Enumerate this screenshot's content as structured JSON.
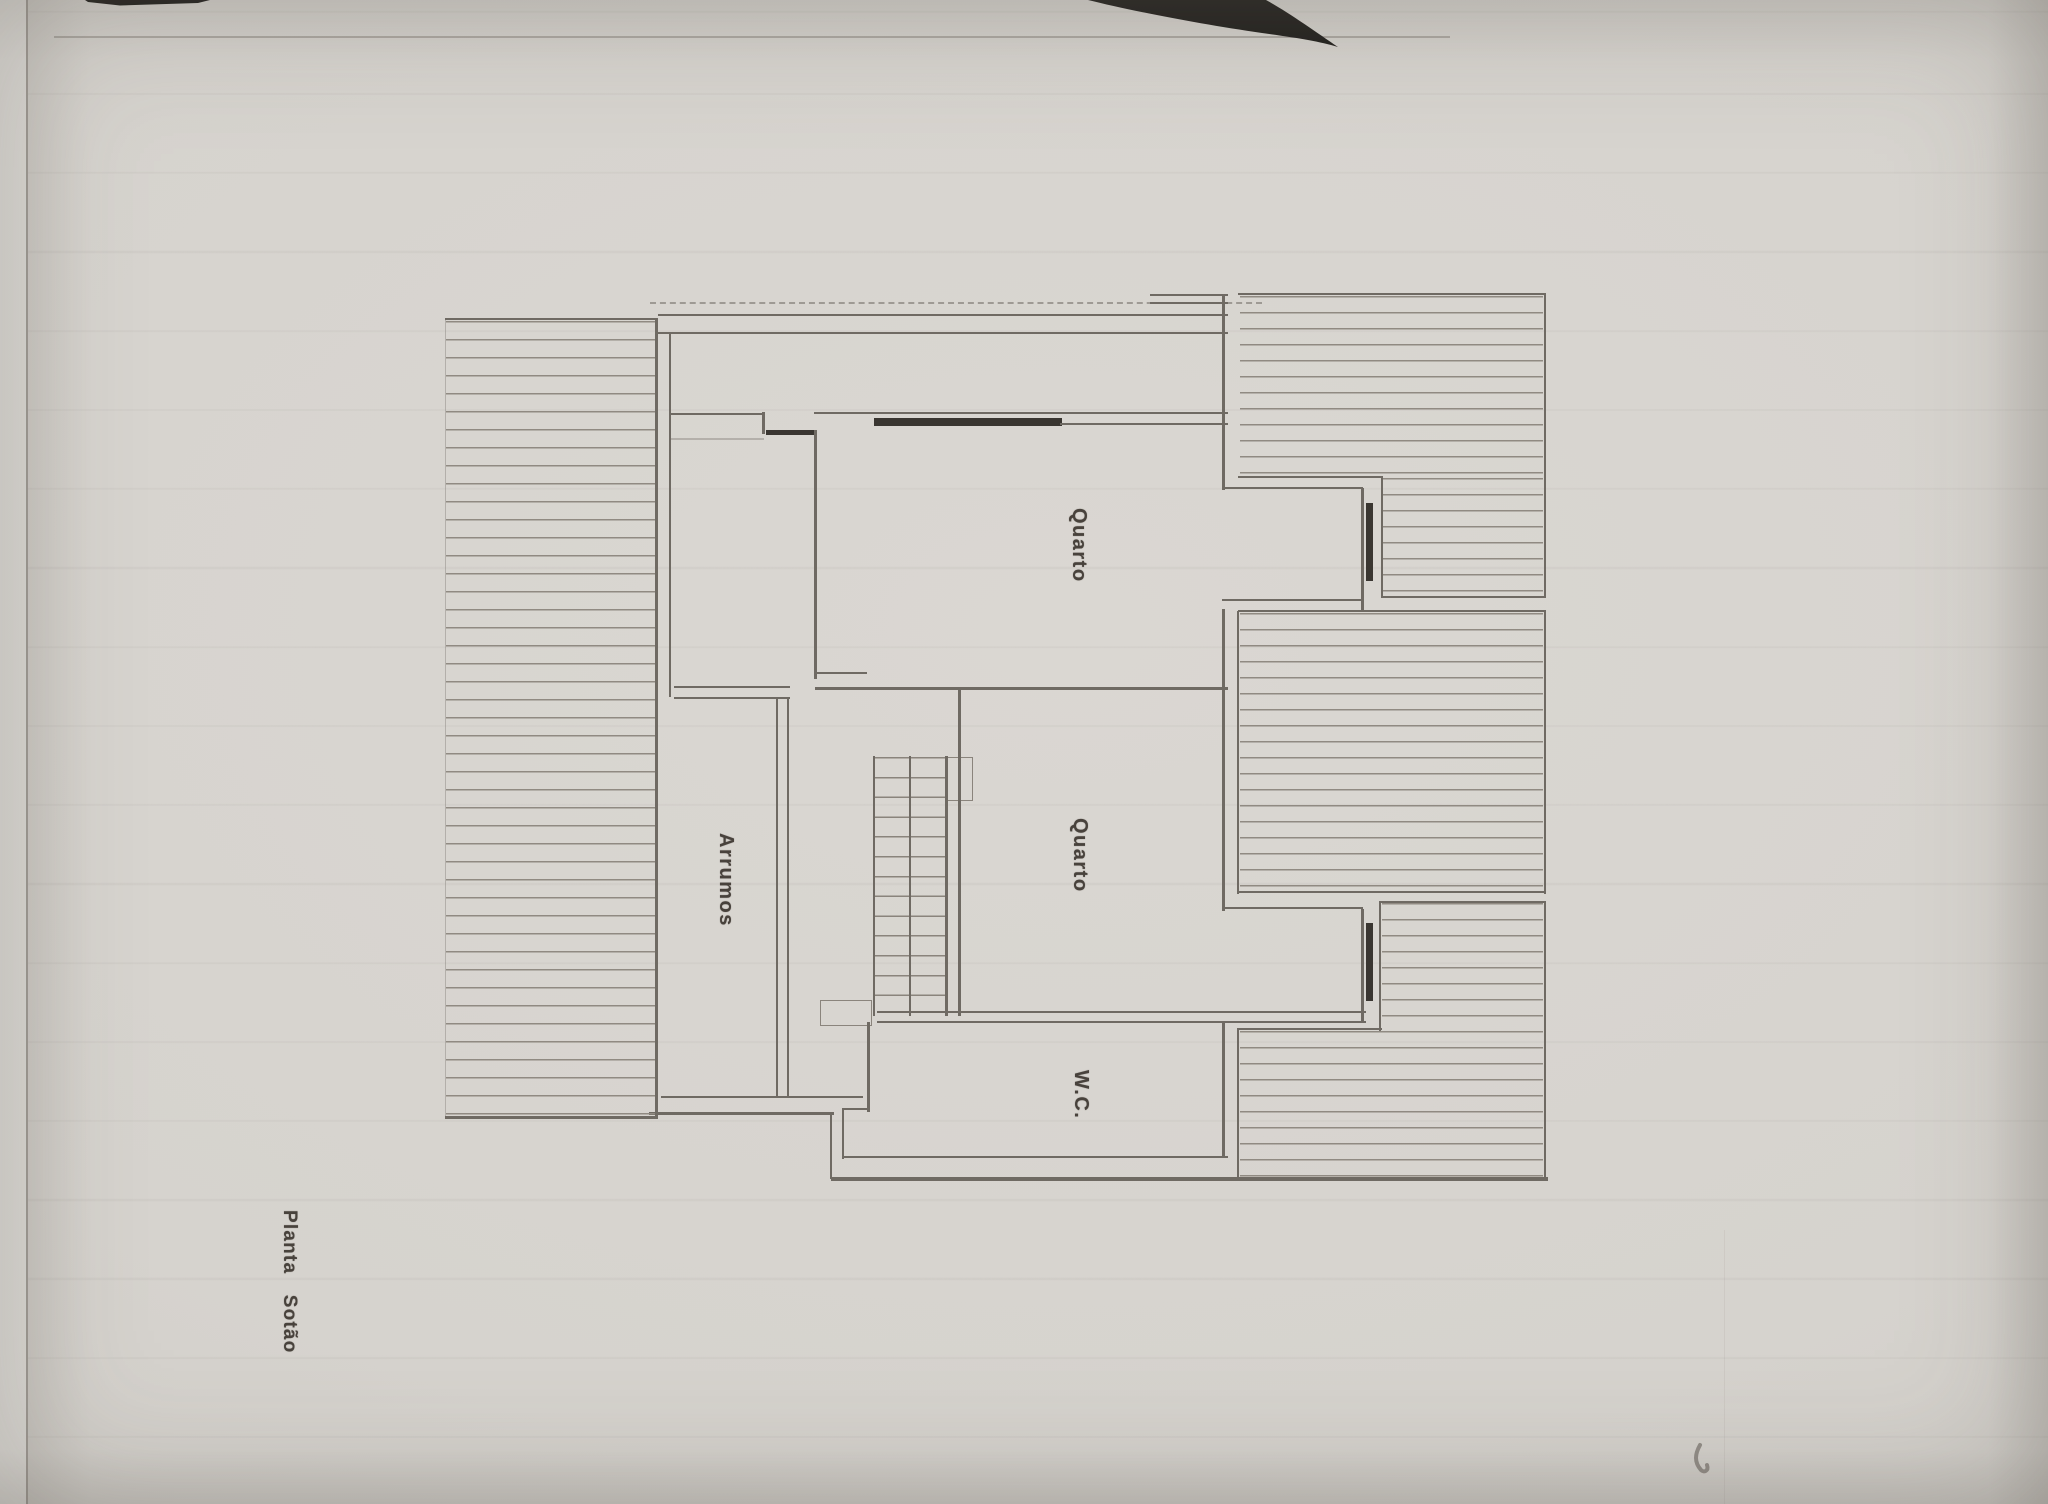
{
  "plan": {
    "title": "Planta Sotão",
    "rooms": [
      {
        "id": "quarto-top",
        "label": "Quarto"
      },
      {
        "id": "quarto-center",
        "label": "Quarto"
      },
      {
        "id": "wc",
        "label": "W.C."
      },
      {
        "id": "arrumos",
        "label": "Arrumos"
      }
    ]
  },
  "colors": {
    "paper": "#d6d3ce",
    "scanner_strip": "#e8e6e2",
    "line": "#6f6a63",
    "line_soft": "#8a847c",
    "hatch": "#908a82",
    "dark_bar": "#3a3631",
    "ink_black": "#1f1d1a",
    "label_text": "#48423c",
    "smudge": "#7b766f"
  }
}
